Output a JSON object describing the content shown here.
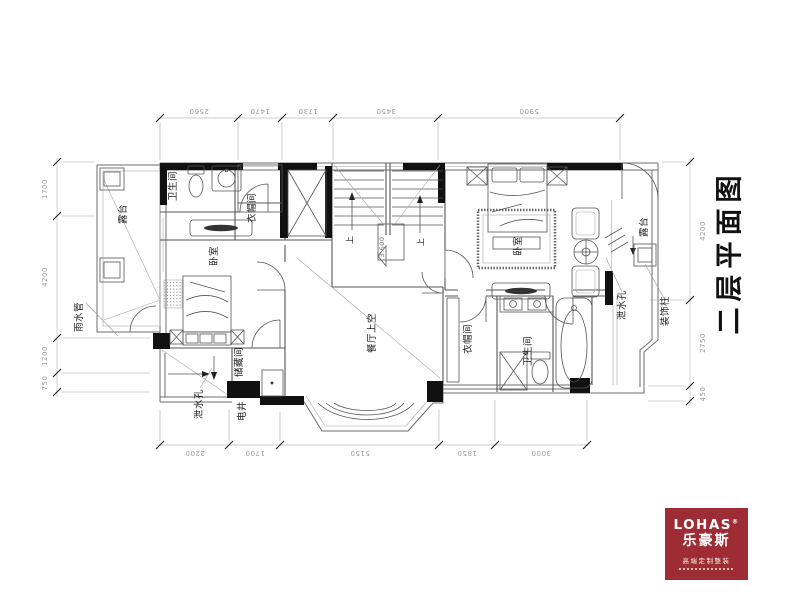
{
  "title": "二层平面图",
  "plan": {
    "rooms": {
      "terrace_left": "露台",
      "bathroom_left": "卫生间",
      "closet_left": "衣帽间",
      "bedroom_left": "卧室",
      "storage": "储藏间",
      "dining_void": "餐厅上空",
      "bedroom_right": "卧室",
      "closet_right": "衣帽间",
      "bathroom_right": "卫生间",
      "terrace_right": "露台"
    },
    "annotations": {
      "rain_pipe": "雨水管",
      "drain_hole_left": "泄水孔",
      "electric_shaft": "电井",
      "drain_hole_right": "泄水孔",
      "decorative_column": "装饰柱",
      "stair_up_left": "上",
      "stair_up_right": "上",
      "stair_level": "3.600"
    },
    "dimensions": {
      "top": [
        "2560",
        "1470",
        "1730",
        "3450",
        "5900"
      ],
      "bottom": [
        "2200",
        "1700",
        "5150",
        "1850",
        "3000"
      ],
      "left": [
        "1700",
        "4200",
        "1200",
        "750"
      ],
      "right": [
        "4200",
        "2750",
        "450"
      ]
    }
  },
  "logo": {
    "brand": "LOHAS",
    "registered": "®",
    "brand_cn": "乐豪斯",
    "tagline": "高端定制整装",
    "bg_color": "#9d2c34"
  }
}
